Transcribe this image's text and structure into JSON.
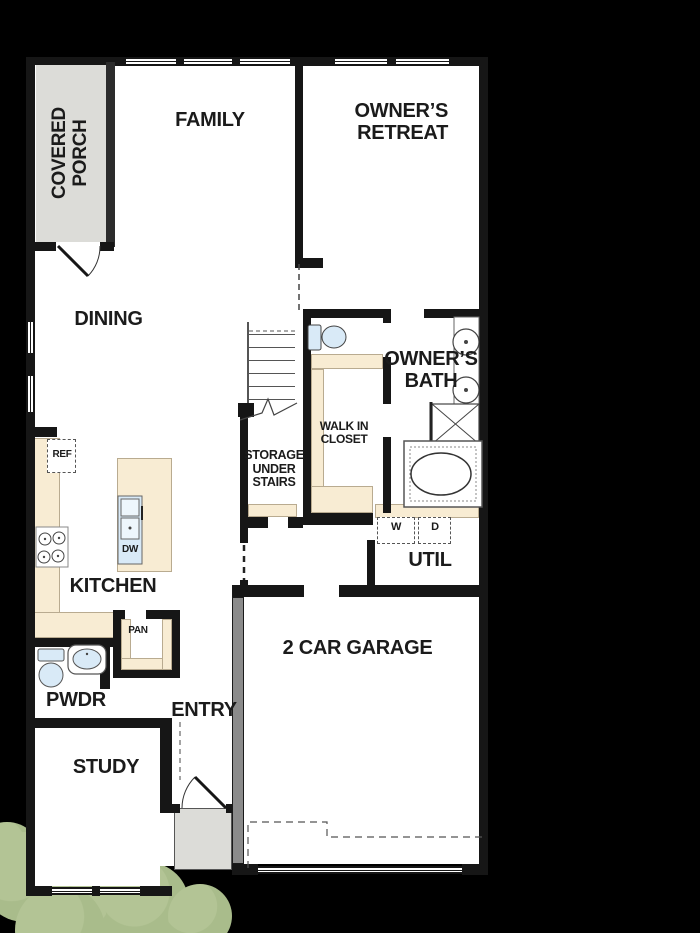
{
  "plan_type": "single-story house floor plan",
  "labels": {
    "covered_porch": "COVERED PORCH",
    "family": "FAMILY",
    "owners_retreat": "OWNER’S RETREAT",
    "dining": "DINING",
    "owners_bath": "OWNER’S BATH",
    "walk_in_closet": "WALK IN CLOSET",
    "storage": "STORAGE UNDER STAIRS",
    "kitchen": "KITCHEN",
    "util": "UTIL",
    "garage": "2 CAR GARAGE",
    "pwdr": "PWDR",
    "entry": "ENTRY",
    "study": "STUDY",
    "ref": "REF",
    "dw": "DW",
    "pan": "PAN",
    "washer": "W",
    "dryer": "D"
  },
  "colors": {
    "background": "#000000",
    "wall": "#161616",
    "floor": "#ffffff",
    "counter_beige": "#f8ecd3",
    "porch_concrete": "#dcdcd8",
    "fixture_blue": "#d9eaf7",
    "tree_green": "#a9bc8b",
    "garage_wall_gray": "#8b8b8b"
  }
}
